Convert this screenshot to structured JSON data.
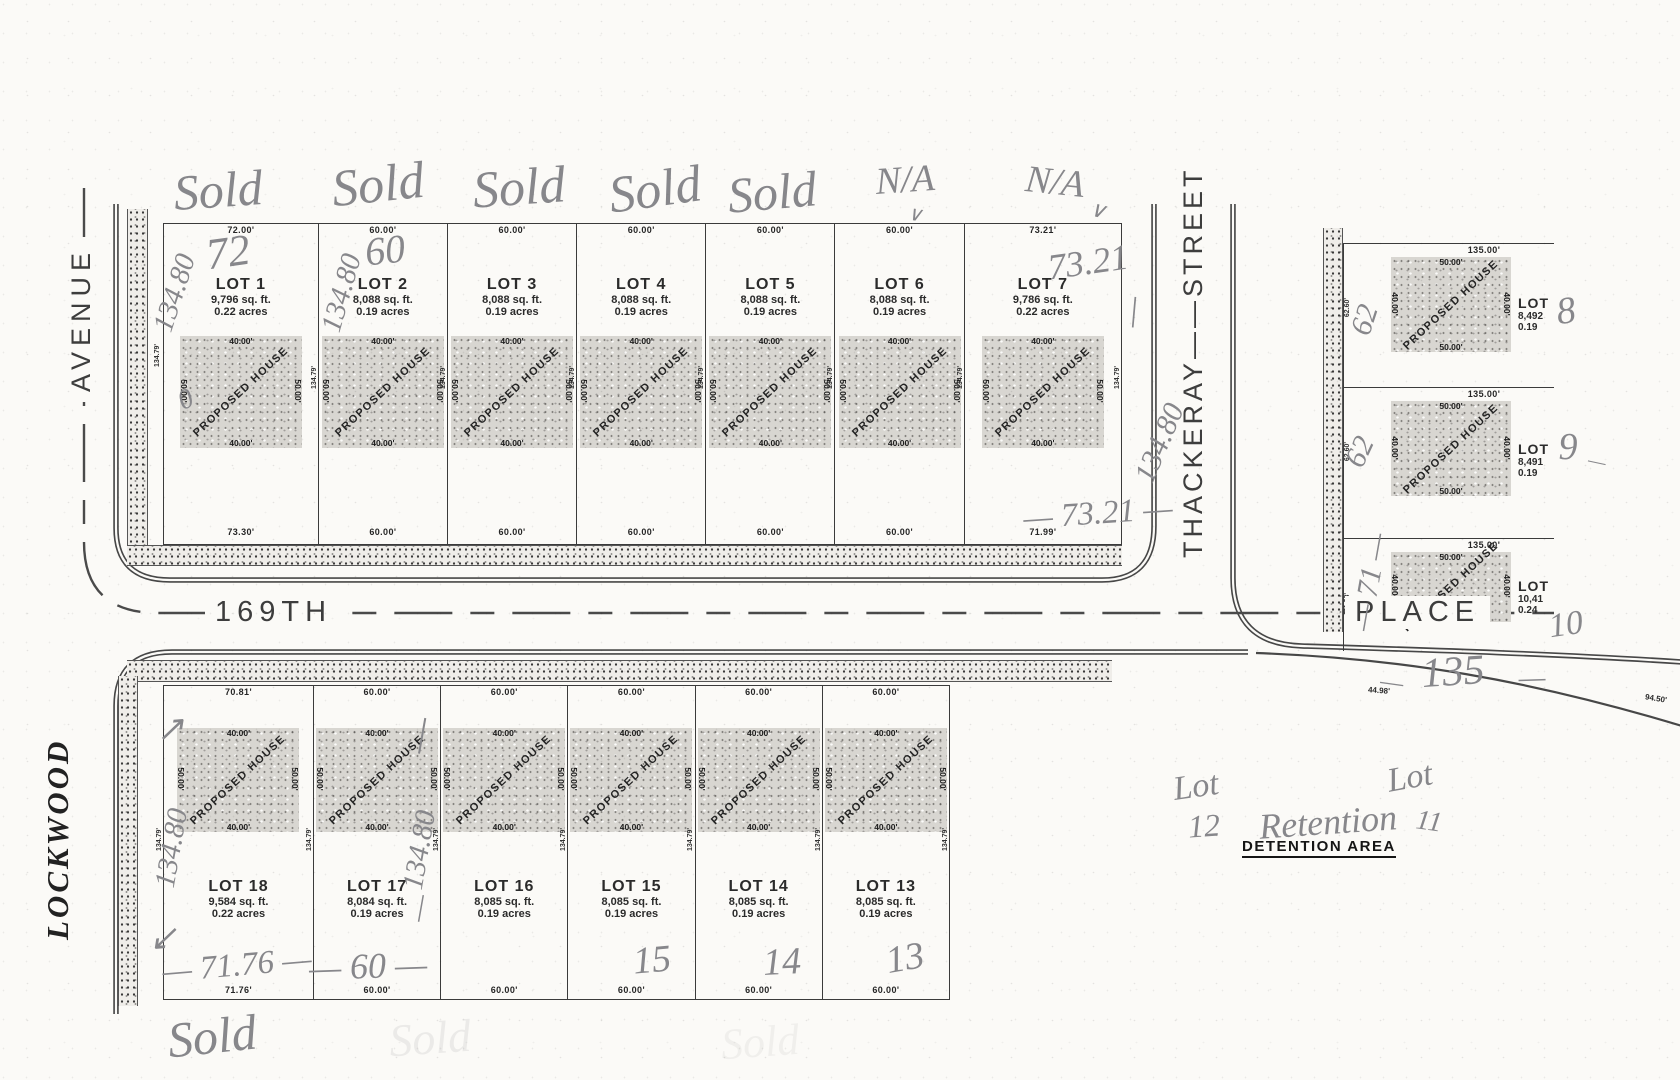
{
  "map": {
    "streets": {
      "avenue": "AVENUE",
      "lockwood": "LOCKWOOD",
      "place_left": "169TH",
      "place_right": "PLACE",
      "thackeray": "THACKERAY——STREET"
    },
    "detention_label": "DETENTION AREA",
    "house_label": "PROPOSED HOUSE",
    "house_width_dim": "40.00'",
    "house_depth_dim": "50.00'",
    "lot_depth_dim": "134.79'",
    "curve_dims": {
      "d1": "44.98'",
      "d2": "94.50'"
    },
    "top_row": [
      {
        "name": "LOT 1",
        "sqft": "9,796 sq. ft.",
        "acres": "0.22 acres",
        "top": "72.00'",
        "bottom": "73.30'",
        "side": "134.79'"
      },
      {
        "name": "LOT 2",
        "sqft": "8,088 sq. ft.",
        "acres": "0.19 acres",
        "top": "60.00'",
        "bottom": "60.00'",
        "side": "134.79'"
      },
      {
        "name": "LOT 3",
        "sqft": "8,088 sq. ft.",
        "acres": "0.19 acres",
        "top": "60.00'",
        "bottom": "60.00'",
        "side": "134.79'"
      },
      {
        "name": "LOT 4",
        "sqft": "8,088 sq. ft.",
        "acres": "0.19 acres",
        "top": "60.00'",
        "bottom": "60.00'",
        "side": "134.79'"
      },
      {
        "name": "LOT 5",
        "sqft": "8,088 sq. ft.",
        "acres": "0.19 acres",
        "top": "60.00'",
        "bottom": "60.00'",
        "side": "134.79'"
      },
      {
        "name": "LOT 6",
        "sqft": "8,088 sq. ft.",
        "acres": "0.19 acres",
        "top": "60.00'",
        "bottom": "60.00'",
        "side": "134.79'"
      },
      {
        "name": "LOT 7",
        "sqft": "9,786 sq. ft.",
        "acres": "0.22 acres",
        "top": "73.21'",
        "bottom": "71.99'",
        "side": "134.79'"
      }
    ],
    "bottom_row": [
      {
        "name": "LOT 18",
        "sqft": "9,584 sq. ft.",
        "acres": "0.22 acres",
        "top": "70.81'",
        "bottom": "71.76'",
        "side": "134.79'"
      },
      {
        "name": "LOT 17",
        "sqft": "8,084 sq. ft.",
        "acres": "0.19 acres",
        "top": "60.00'",
        "bottom": "60.00'",
        "side": "134.79'"
      },
      {
        "name": "LOT 16",
        "sqft": "8,085 sq. ft.",
        "acres": "0.19 acres",
        "top": "60.00'",
        "bottom": "60.00'",
        "side": "134.79'"
      },
      {
        "name": "LOT 15",
        "sqft": "8,085 sq. ft.",
        "acres": "0.19 acres",
        "top": "60.00'",
        "bottom": "60.00'",
        "side": "134.79'"
      },
      {
        "name": "LOT 14",
        "sqft": "8,085 sq. ft.",
        "acres": "0.19 acres",
        "top": "60.00'",
        "bottom": "60.00'",
        "side": "134.79'"
      },
      {
        "name": "LOT 13",
        "sqft": "8,085 sq. ft.",
        "acres": "0.19 acres",
        "top": "60.00'",
        "bottom": "60.00'",
        "side": "134.79'"
      }
    ],
    "right_col": [
      {
        "name": "LOT 8",
        "sqft": "8,492",
        "acres": "0.19",
        "top": "135.00'",
        "side": "62.60'"
      },
      {
        "name": "LOT 9",
        "sqft": "8,491",
        "acres": "0.19",
        "top": "135.00'",
        "side": "62.60'"
      },
      {
        "name": "LOT 10",
        "sqft": "10,41",
        "acres": "0.24",
        "top": "135.00'",
        "side": "71.98'"
      }
    ],
    "annotations": [
      {
        "t": "Sold",
        "x": 218,
        "y": 190,
        "s": 50,
        "r": -4
      },
      {
        "t": "Sold",
        "x": 378,
        "y": 185,
        "s": 52,
        "r": -6
      },
      {
        "t": "Sold",
        "x": 519,
        "y": 188,
        "s": 52,
        "r": -4
      },
      {
        "t": "Sold",
        "x": 655,
        "y": 190,
        "s": 52,
        "r": -8
      },
      {
        "t": "Sold",
        "x": 772,
        "y": 192,
        "s": 50,
        "r": -5
      },
      {
        "t": "N/A",
        "x": 905,
        "y": 180,
        "s": 38,
        "r": -4
      },
      {
        "t": "∨",
        "x": 915,
        "y": 214,
        "s": 20,
        "r": 8
      },
      {
        "t": "N/A",
        "x": 1055,
        "y": 182,
        "s": 38,
        "r": 6
      },
      {
        "t": "∨",
        "x": 1098,
        "y": 210,
        "s": 22,
        "r": 14
      },
      {
        "t": "72",
        "x": 228,
        "y": 252,
        "s": 44,
        "r": -8
      },
      {
        "t": "134.80",
        "x": 175,
        "y": 293,
        "s": 29,
        "r": -72
      },
      {
        "t": "60",
        "x": 385,
        "y": 250,
        "s": 40,
        "r": -6
      },
      {
        "t": "134.80",
        "x": 342,
        "y": 293,
        "s": 29,
        "r": -74
      },
      {
        "t": "0",
        "x": 186,
        "y": 400,
        "s": 28,
        "r": -25
      },
      {
        "t": "73.21",
        "x": 1088,
        "y": 262,
        "s": 36,
        "r": -8
      },
      {
        "t": "—",
        "x": 1132,
        "y": 312,
        "s": 34,
        "r": -85
      },
      {
        "t": "134.80",
        "x": 1160,
        "y": 443,
        "s": 30,
        "r": -67
      },
      {
        "t": "— 73.21 —",
        "x": 1098,
        "y": 514,
        "s": 33,
        "r": -4
      },
      {
        "t": "62",
        "x": 1365,
        "y": 320,
        "s": 30,
        "r": -72
      },
      {
        "t": "62",
        "x": 1360,
        "y": 452,
        "s": 30,
        "r": -65
      },
      {
        "t": "8",
        "x": 1566,
        "y": 311,
        "s": 38,
        "r": -8
      },
      {
        "t": "9",
        "x": 1568,
        "y": 447,
        "s": 38,
        "r": 0
      },
      {
        "t": "—",
        "x": 1597,
        "y": 462,
        "s": 20,
        "r": 12
      },
      {
        "t": "— 71 —",
        "x": 1370,
        "y": 582,
        "s": 30,
        "r": -80
      },
      {
        "t": "10",
        "x": 1566,
        "y": 625,
        "s": 34,
        "r": -8
      },
      {
        "t": "135",
        "x": 1453,
        "y": 672,
        "s": 42,
        "r": -4
      },
      {
        "t": "—",
        "x": 1392,
        "y": 682,
        "s": 26,
        "r": 8
      },
      {
        "t": "—",
        "x": 1532,
        "y": 678,
        "s": 30,
        "r": -2
      },
      {
        "t": "↗",
        "x": 170,
        "y": 729,
        "s": 34,
        "r": -5
      },
      {
        "t": "134.80",
        "x": 172,
        "y": 848,
        "s": 29,
        "r": -80
      },
      {
        "t": "↙",
        "x": 163,
        "y": 938,
        "s": 34,
        "r": -5
      },
      {
        "t": "—",
        "x": 418,
        "y": 735,
        "s": 40,
        "r": -80
      },
      {
        "t": "134.80",
        "x": 420,
        "y": 850,
        "s": 29,
        "r": -80
      },
      {
        "t": "—",
        "x": 419,
        "y": 908,
        "s": 30,
        "r": -80
      },
      {
        "t": "— 71.76 —",
        "x": 237,
        "y": 966,
        "s": 33,
        "r": -5
      },
      {
        "t": "— 60 —",
        "x": 368,
        "y": 966,
        "s": 36,
        "r": -2
      },
      {
        "t": "15",
        "x": 652,
        "y": 960,
        "s": 38,
        "r": -5
      },
      {
        "t": "14",
        "x": 782,
        "y": 962,
        "s": 38,
        "r": -3
      },
      {
        "t": "13",
        "x": 905,
        "y": 958,
        "s": 38,
        "r": -10
      },
      {
        "t": "Sold",
        "x": 212,
        "y": 1036,
        "s": 50,
        "r": -6
      },
      {
        "t": "Sold",
        "x": 430,
        "y": 1038,
        "s": 46,
        "r": -4,
        "o": 0.13
      },
      {
        "t": "Sold",
        "x": 760,
        "y": 1042,
        "s": 44,
        "r": -4,
        "o": 0.09
      },
      {
        "t": "Lot",
        "x": 1196,
        "y": 787,
        "s": 34,
        "r": -8
      },
      {
        "t": "12",
        "x": 1204,
        "y": 826,
        "s": 32,
        "r": -4
      },
      {
        "t": "Retention",
        "x": 1328,
        "y": 822,
        "s": 36,
        "r": -4
      },
      {
        "t": "Lot",
        "x": 1410,
        "y": 778,
        "s": 34,
        "r": -10
      },
      {
        "t": "11",
        "x": 1429,
        "y": 822,
        "s": 28,
        "r": 8
      }
    ]
  }
}
